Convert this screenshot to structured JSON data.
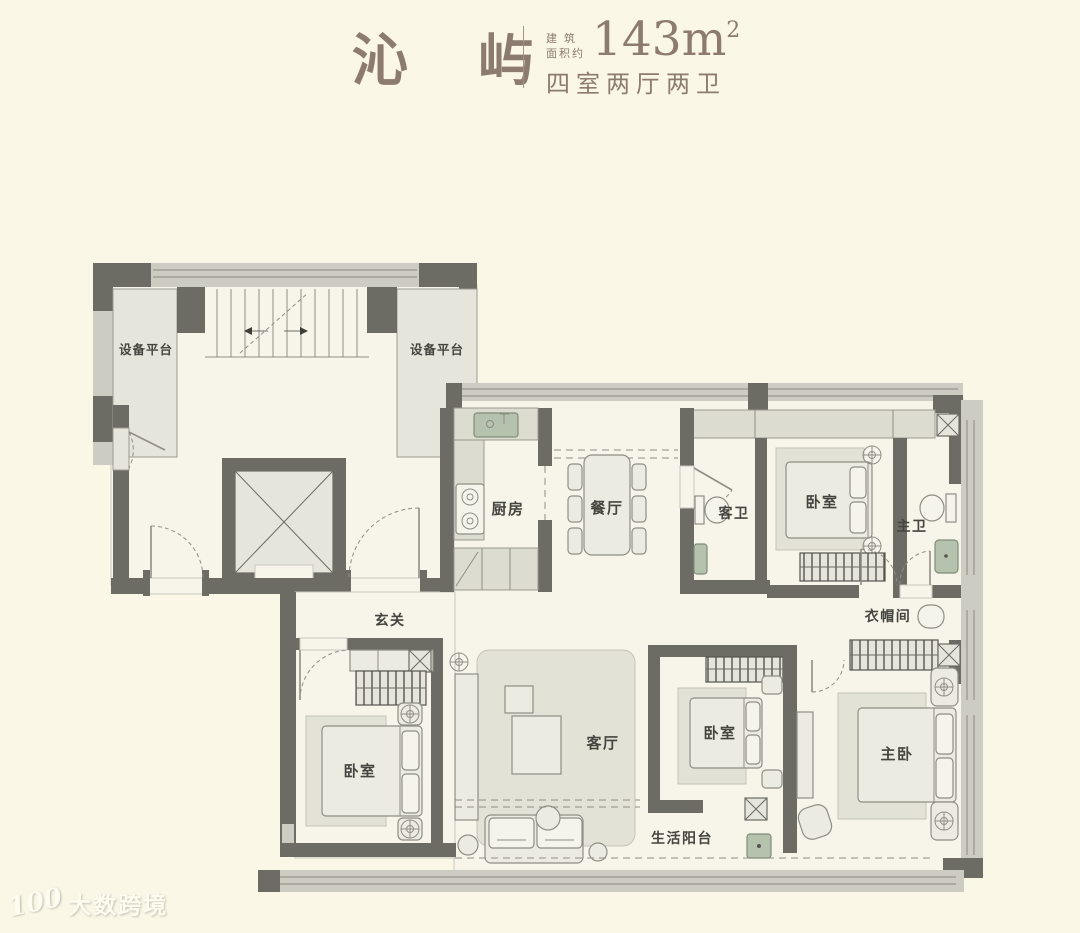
{
  "header": {
    "title": "沁 屿",
    "area_label_line1": "建 筑",
    "area_label_line2": "面积约",
    "area_value": "143m",
    "area_exponent": "2",
    "layout_text": "四室两厅两卫"
  },
  "floorplan": {
    "rooms": {
      "equipment_platform_left": "设备平台",
      "equipment_platform_right": "设备平台",
      "kitchen": "厨房",
      "dining_room": "餐厅",
      "guest_bathroom": "客卫",
      "bedroom_top_right": "卧室",
      "master_bathroom": "主卫",
      "foyer": "玄关",
      "cloakroom": "衣帽间",
      "bedroom_left": "卧室",
      "living_room": "客厅",
      "bedroom_middle": "卧室",
      "master_bedroom": "主卧",
      "balcony": "生活阳台"
    }
  },
  "watermark": {
    "logo_text": "100",
    "brand_text": "大数跨境"
  },
  "colors": {
    "background": "#FAF7E6",
    "wall_dark": "#6C6B64",
    "wall_light": "#CDCCC3",
    "furniture_fill": "#ECEBE1",
    "fixture_green": "#B5C3AE",
    "title_brown": "#8C7B6E"
  }
}
